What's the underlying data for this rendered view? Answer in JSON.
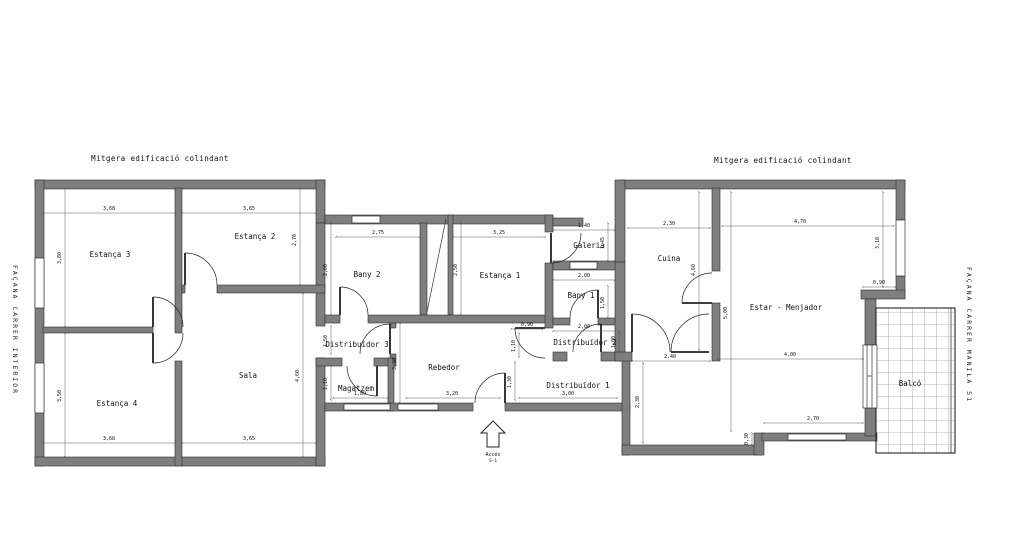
{
  "labels": {
    "mitgera_left": "Mitgera edificació colindant",
    "mitgera_right": "Mitgera edificació colindant",
    "facana_left": "FAÇANA CARRER INTERIOR",
    "facana_right": "FAÇANA CARRER MANILA 51",
    "acces": "Accés",
    "acces_sub": "S-1"
  },
  "rooms": {
    "estanca3": "Estança 3",
    "estanca2": "Estança 2",
    "estanca4": "Estança 4",
    "sala": "Sala",
    "bany2": "Bany 2",
    "distribuidor3": "Distribuïdor 3",
    "magatzem": "Magatzem",
    "rebedor": "Rebedor",
    "estanca1": "Estança 1",
    "galeria": "Galeria",
    "bany1": "Bany 1",
    "distribuidor2": "Distribuïdor 2",
    "distribuidor1": "Distribuïdor 1",
    "cuina": "Cuina",
    "estar": "Estar - Menjador",
    "balco": "Balcó"
  },
  "dims": {
    "e3_top": "3,68",
    "e3_left": "3,80",
    "e2_top": "3,65",
    "e2_right": "2,70",
    "e4_left": "3,50",
    "e4_bottom": "3,68",
    "sala_bottom": "3,65",
    "sala_right": "4,60",
    "bany2_top": "2,75",
    "bany2_left": "2,60",
    "est1_top": "3,25",
    "est1_left": "2,50",
    "dist3_left": "1,50",
    "magatzem_left": "1,10",
    "magatzem_bottom": "1,80",
    "rebedor_left": "3,30",
    "rebedor_bottom": "3,20",
    "nook_w": "0,90",
    "nook_h": "1,10",
    "galeria_top": "1,40",
    "galeria_right": "1,45",
    "bany1_top": "2,00",
    "bany1_right": "1,50",
    "dist2_top": "2,00",
    "dist2_right": "1,00",
    "dist1_left": "1,30",
    "dist1_bottom": "3,00",
    "dist1_right": "2,30",
    "cuina_top": "2,30",
    "cuina_left": "4,60",
    "cuina_bottom": "2,40",
    "estar_top": "4,70",
    "estar_left": "5,00",
    "estar_right": "3,10",
    "estar_step": "0,90",
    "estar_mid": "4,00",
    "estar_bottom": "2,70",
    "estar_corner": "0,30"
  },
  "colors": {
    "wall": "#7e7e7e",
    "wall_edge": "#2f2f2f",
    "dim_line": "#4a4a4a",
    "text": "#111111",
    "background": "#ffffff"
  }
}
